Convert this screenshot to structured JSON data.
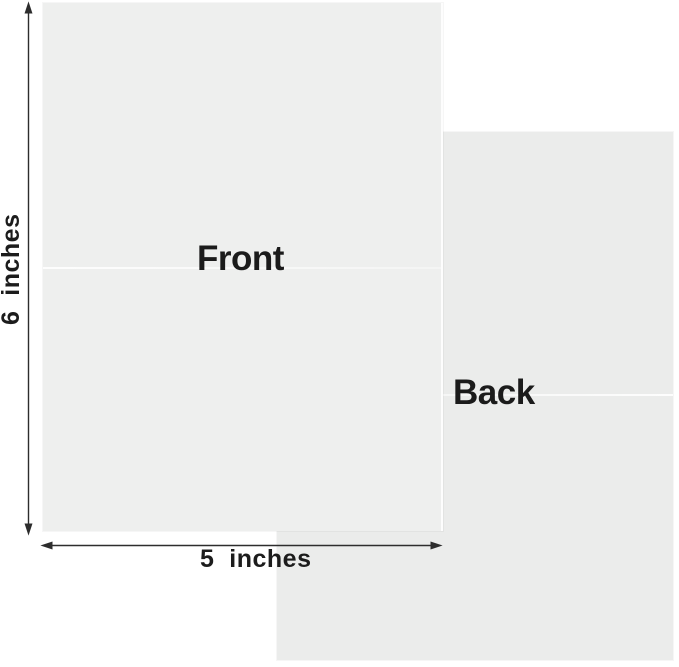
{
  "diagram": {
    "title_semantic": "greeting-card-size-diagram",
    "front_card": {
      "label": "Front"
    },
    "back_card": {
      "label": "Back"
    },
    "dimensions": {
      "height_label": "6  inches",
      "width_label": "5  inches"
    },
    "colors": {
      "background": "#ffffff",
      "front_card": "#eeefee",
      "back_card": "#ebeceb",
      "fold_line": "#f8f8f8",
      "arrow": "#2d2d2d",
      "text": "#1b1b1b"
    }
  }
}
